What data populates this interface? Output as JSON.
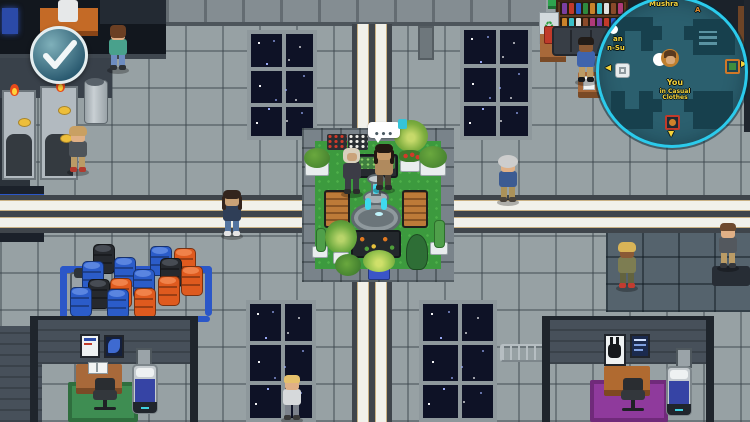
{
  "hud": {
    "ready_button": {
      "icon": "checkmark",
      "ring_color": "#e4edef",
      "fill": "#2a5a70"
    },
    "speech_bubble": {
      "dots": "•••",
      "tag_color": "#35c4d8"
    },
    "minimap": {
      "ring_color": "#2bcbec",
      "map_bg": "#2b5f6e",
      "player_label": "You",
      "player_status": "in Casual Clothes",
      "npc_label_line1": "an",
      "npc_label_line2": "n-Su",
      "area_label_top": "Mushra",
      "area_label_top_right": "A"
    }
  },
  "palette": {
    "floor": "#97a1a4",
    "dark_floor": "#55636d",
    "walkway_white": "#f1f1ea",
    "walkway_trim": "#c9b183",
    "grass": "#3c9a3e",
    "fountain_water": "#3fd9ef",
    "rug_green": "#3e8d52",
    "rug_purple": "#8f3a9c",
    "pipe_blue": "#2b57c8",
    "space_window": "#0e1226"
  },
  "npcs": [
    {
      "id": "npc-teal-shirt",
      "x": 106,
      "y": 24,
      "hair": "#6b3f23",
      "skin": "#e0b086",
      "top": "#49a18c",
      "pants": "#6d8cc0",
      "shoes": "#2e3236",
      "style": "back"
    },
    {
      "id": "npc-khaki-walker",
      "x": 66,
      "y": 126,
      "hair": "#c9a063",
      "skin": "#e0b086",
      "top": "#4e545a",
      "pants": "#bb9c66",
      "shoes": "#b23a2e",
      "style": "bob"
    },
    {
      "id": "npc-curly-road",
      "x": 220,
      "y": 190,
      "hair": "#33241d",
      "skin": "#c9a176",
      "top": "#2f3e57",
      "pants": "#53749f",
      "shoes": "#e5e5e5",
      "style": "long"
    },
    {
      "id": "npc-gray-hair-road",
      "x": 496,
      "y": 156,
      "hair": "#cdcdcd",
      "skin": "#e0b086",
      "top": "#3c5b92",
      "pants": "#ab9259",
      "shoes": "#4a443c",
      "style": "puff"
    },
    {
      "id": "npc-olive-jacket",
      "x": 615,
      "y": 242,
      "hair": "#d9b457",
      "skin": "#8a5a36",
      "top": "#7d7d52",
      "pants": "#63633f",
      "shoes": "#c23c30",
      "style": "bob"
    },
    {
      "id": "npc-right-edge",
      "x": 716,
      "y": 222,
      "hair": "#6e4a2e",
      "skin": "#e0b086",
      "top": "#53585e",
      "pants": "#bb9c66",
      "shoes": "#33363b",
      "style": "short"
    },
    {
      "id": "npc-bottom-blonde",
      "x": 280,
      "y": 374,
      "hair": "#e5c06b",
      "skin": "#e0b086",
      "top": "#d6d9db",
      "pants": "#7c828c",
      "shoes": "#3a3a3a",
      "style": "short"
    },
    {
      "id": "npc-shop-clerk",
      "x": 574,
      "y": 36,
      "hair": "#221c18",
      "skin": "#8a5a36",
      "top": "#3f64ad",
      "pants": "#bb9c66",
      "shoes": "#16181b",
      "style": "short"
    },
    {
      "id": "npc-garden-hooded",
      "x": 340,
      "y": 148,
      "hair": "#d9d0bd",
      "skin": "#caa37a",
      "top": "#3c3c46",
      "pants": "#3c3c46",
      "shoes": "#2b2b2b",
      "style": "hood"
    },
    {
      "id": "npc-garden-tan",
      "x": 372,
      "y": 144,
      "hair": "#241812",
      "skin": "#c89a6a",
      "top": "#b08a5e",
      "pants": "#4a3f35",
      "shoes": "#2b2b2b",
      "style": "long"
    }
  ],
  "barrels": {
    "colors": {
      "blue": {
        "body": "#2b5cc9",
        "top": "#5a85e0"
      },
      "orange": {
        "body": "#df5a1e",
        "top": "#f0824a"
      },
      "black": {
        "body": "#26292e",
        "top": "#474c54"
      }
    },
    "items": [
      [
        93,
        244,
        "black"
      ],
      [
        150,
        246,
        "blue"
      ],
      [
        174,
        248,
        "orange"
      ],
      [
        82,
        261,
        "blue"
      ],
      [
        114,
        257,
        "blue"
      ],
      [
        160,
        258,
        "black"
      ],
      [
        181,
        266,
        "orange"
      ],
      [
        133,
        269,
        "blue"
      ],
      [
        158,
        276,
        "orange"
      ],
      [
        88,
        279,
        "black"
      ],
      [
        110,
        278,
        "orange"
      ],
      [
        70,
        287,
        "blue"
      ],
      [
        107,
        289,
        "blue"
      ],
      [
        134,
        288,
        "orange"
      ]
    ]
  },
  "windows": [
    {
      "x": 247,
      "y": 30,
      "w": 70,
      "h": 110
    },
    {
      "x": 460,
      "y": 26,
      "w": 72,
      "h": 114
    },
    {
      "x": 246,
      "y": 300,
      "w": 70,
      "h": 122
    },
    {
      "x": 419,
      "y": 300,
      "w": 78,
      "h": 122
    }
  ],
  "star_colors": [
    "#ffffff",
    "#9fb0ff"
  ],
  "book_colors": [
    "#7a3fa0",
    "#c23a2a",
    "#2b5cc9",
    "#2e8a3e",
    "#c9822a",
    "#3ac0c9",
    "#e0e0e0",
    "#8a4a2a",
    "#b03a7a"
  ]
}
